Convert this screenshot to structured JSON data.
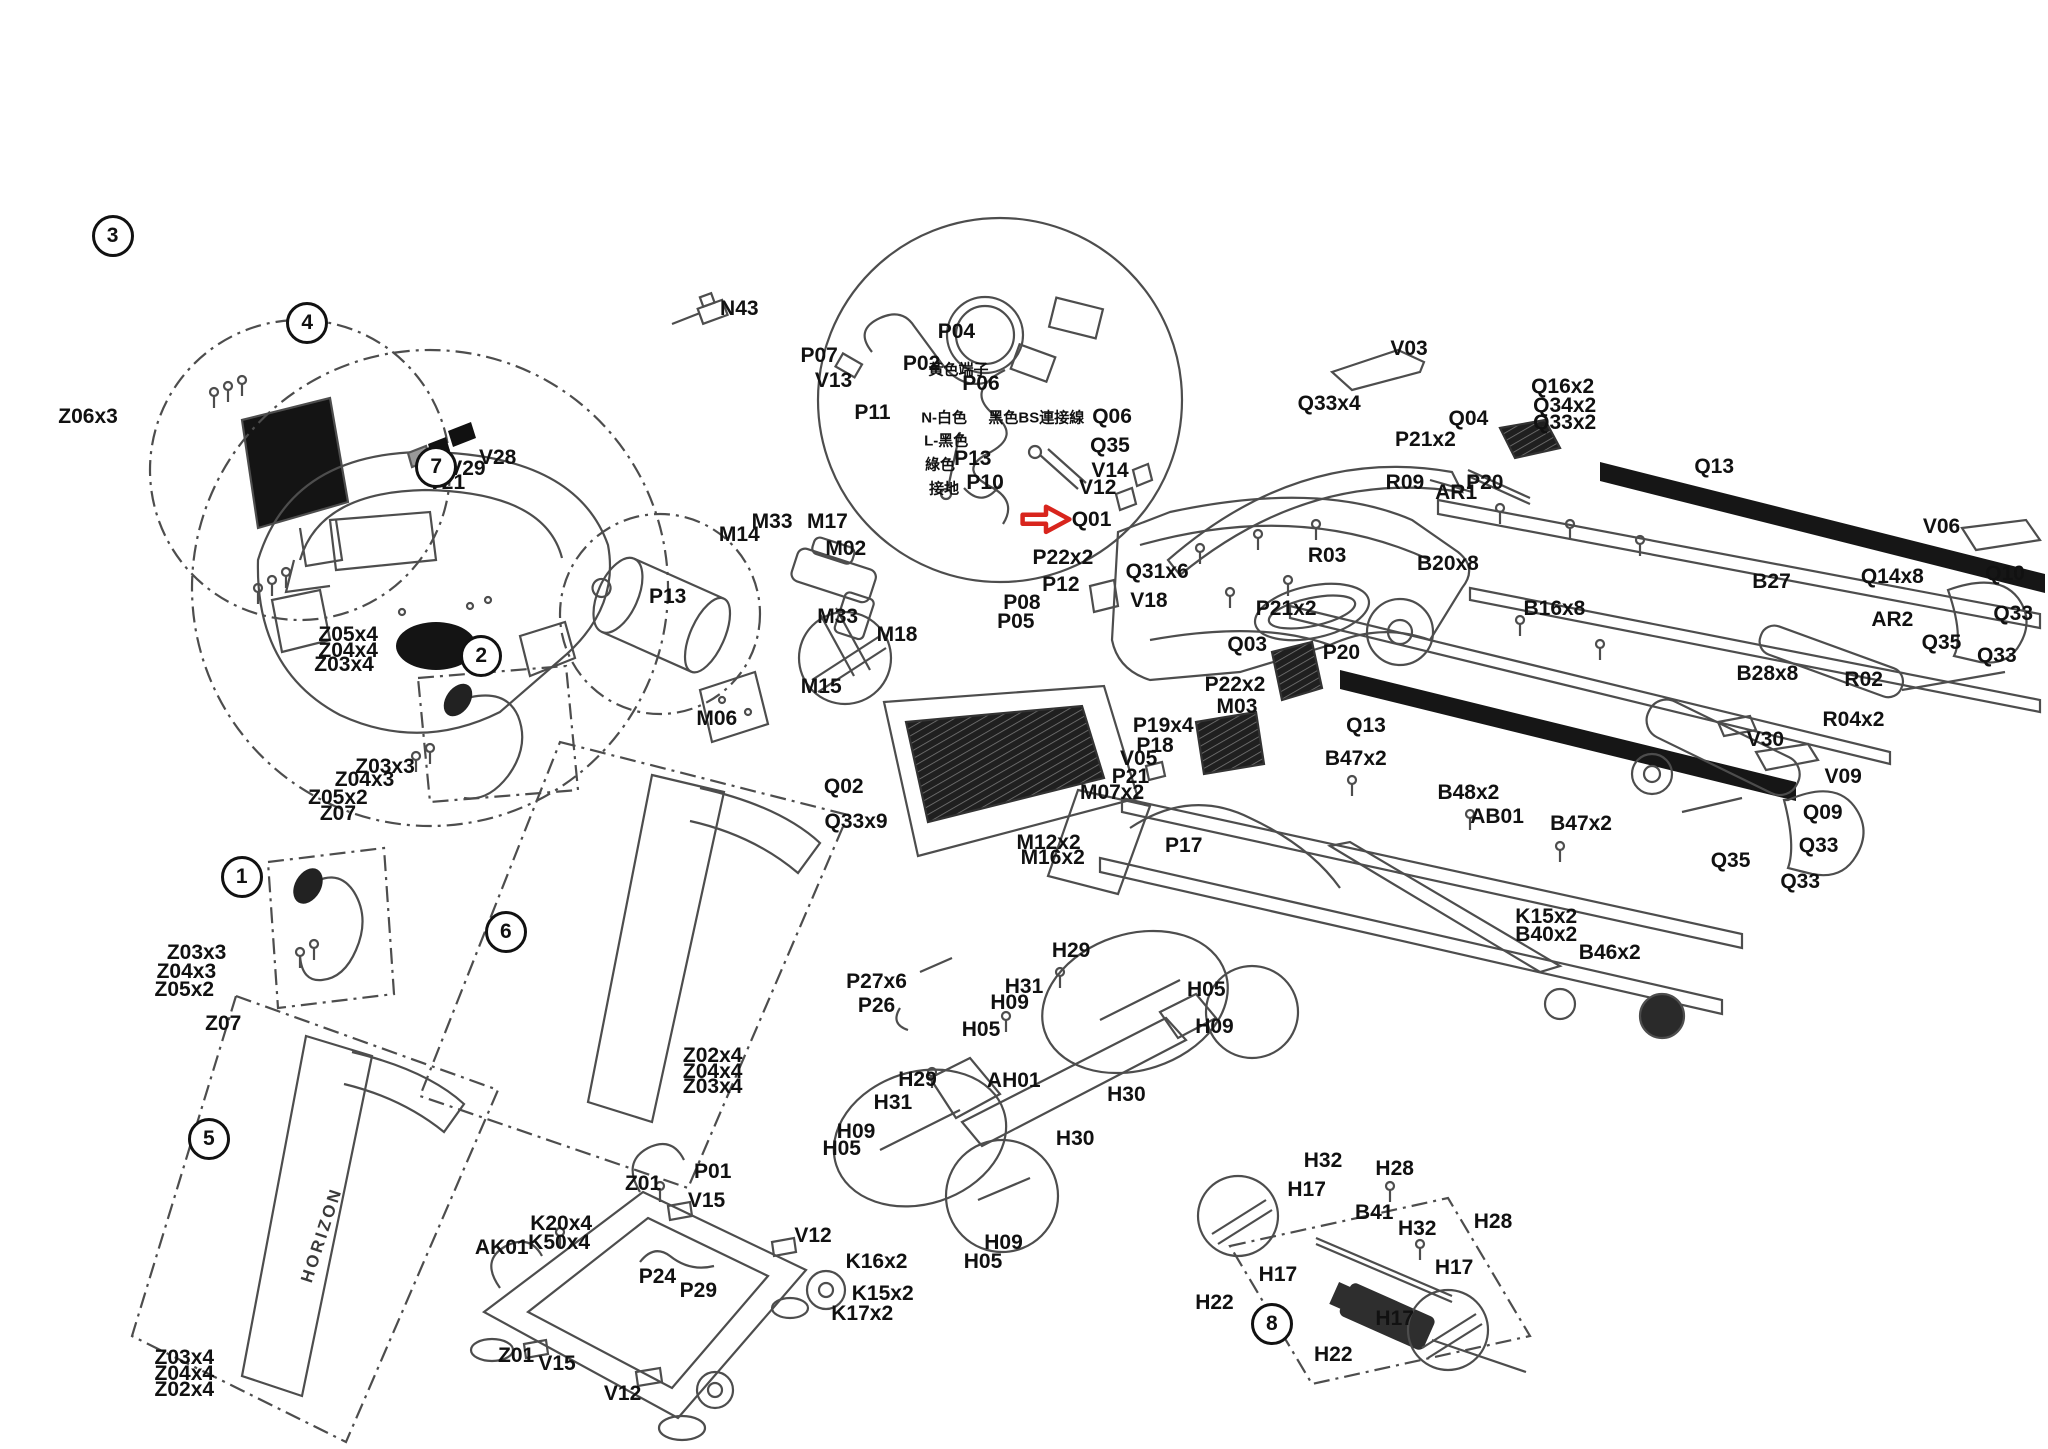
{
  "meta": {
    "diagram_type": "treadmill-exploded-parts-diagram"
  },
  "colors": {
    "label": "#111111",
    "line": "#4d4d4d",
    "dark_fill": "#161616",
    "highlight_arrow": "#d8251d",
    "sticker_gray": "#999999"
  },
  "brand": "HORIZON",
  "highlight": {
    "part_id": "Q01",
    "x": 52.4,
    "y": 35.9
  },
  "balloons": [
    {
      "n": "3",
      "x": 5.5,
      "y": 16.3
    },
    {
      "n": "4",
      "x": 15.0,
      "y": 22.3
    },
    {
      "n": "7",
      "x": 21.3,
      "y": 32.2
    },
    {
      "n": "2",
      "x": 23.5,
      "y": 45.3
    },
    {
      "n": "1",
      "x": 11.8,
      "y": 60.5
    },
    {
      "n": "6",
      "x": 24.7,
      "y": 64.3
    },
    {
      "n": "5",
      "x": 10.2,
      "y": 78.6
    },
    {
      "n": "8",
      "x": 62.1,
      "y": 91.4
    }
  ],
  "labels": [
    {
      "t": "Z06x3",
      "x": 4.3,
      "y": 28.8
    },
    {
      "t": "V28",
      "x": 24.3,
      "y": 31.6
    },
    {
      "t": "V29",
      "x": 22.8,
      "y": 32.4
    },
    {
      "t": "V21",
      "x": 21.8,
      "y": 33.3
    },
    {
      "t": "N43",
      "x": 36.1,
      "y": 21.3
    },
    {
      "t": "P07",
      "x": 40.0,
      "y": 24.6
    },
    {
      "t": "V13",
      "x": 40.7,
      "y": 26.3
    },
    {
      "t": "P11",
      "x": 42.6,
      "y": 28.5
    },
    {
      "t": "P02",
      "x": 45.0,
      "y": 25.1
    },
    {
      "t": "P04",
      "x": 46.7,
      "y": 22.9
    },
    {
      "t": "黃色端子",
      "x": 46.8,
      "y": 25.5,
      "cn": true
    },
    {
      "t": "P06",
      "x": 47.9,
      "y": 26.5
    },
    {
      "t": "N-白色",
      "x": 46.1,
      "y": 28.8,
      "cn": true
    },
    {
      "t": "黑色BS連接線",
      "x": 50.6,
      "y": 28.8,
      "cn": true
    },
    {
      "t": "L-黑色",
      "x": 46.2,
      "y": 30.4,
      "cn": true
    },
    {
      "t": "綠色",
      "x": 45.9,
      "y": 32.0,
      "cn": true
    },
    {
      "t": "P13",
      "x": 47.5,
      "y": 31.7
    },
    {
      "t": "接地",
      "x": 46.1,
      "y": 33.7,
      "cn": true
    },
    {
      "t": "P10",
      "x": 48.1,
      "y": 33.3
    },
    {
      "t": "V03",
      "x": 68.8,
      "y": 24.1
    },
    {
      "t": "Q06",
      "x": 54.3,
      "y": 28.8
    },
    {
      "t": "Q33x4",
      "x": 64.9,
      "y": 27.9
    },
    {
      "t": "Q35",
      "x": 54.2,
      "y": 30.8
    },
    {
      "t": "V14",
      "x": 54.2,
      "y": 32.5
    },
    {
      "t": "V12",
      "x": 53.6,
      "y": 33.7
    },
    {
      "t": "Q01",
      "x": 53.3,
      "y": 35.9
    },
    {
      "t": "Q31x6",
      "x": 56.5,
      "y": 39.5
    },
    {
      "t": "R03",
      "x": 64.8,
      "y": 38.4
    },
    {
      "t": "B20x8",
      "x": 70.7,
      "y": 38.9
    },
    {
      "t": "P21x2",
      "x": 62.8,
      "y": 42.0
    },
    {
      "t": "P20",
      "x": 65.5,
      "y": 45.1
    },
    {
      "t": "Q03",
      "x": 60.9,
      "y": 44.5
    },
    {
      "t": "V18",
      "x": 56.1,
      "y": 41.5
    },
    {
      "t": "P22x2",
      "x": 51.9,
      "y": 38.5
    },
    {
      "t": "P12",
      "x": 51.8,
      "y": 40.4
    },
    {
      "t": "P08",
      "x": 49.9,
      "y": 41.6
    },
    {
      "t": "P05",
      "x": 49.6,
      "y": 42.9
    },
    {
      "t": "Q16x2",
      "x": 76.3,
      "y": 26.7
    },
    {
      "t": "Q34x2",
      "x": 76.4,
      "y": 28.0
    },
    {
      "t": "Q33x2",
      "x": 76.4,
      "y": 29.2
    },
    {
      "t": "Q04",
      "x": 71.7,
      "y": 28.9
    },
    {
      "t": "P21x2",
      "x": 69.6,
      "y": 30.4
    },
    {
      "t": "P20",
      "x": 72.5,
      "y": 33.3
    },
    {
      "t": "AR1",
      "x": 71.1,
      "y": 34.0
    },
    {
      "t": "R09",
      "x": 68.6,
      "y": 33.3
    },
    {
      "t": "Q13",
      "x": 83.7,
      "y": 32.2
    },
    {
      "t": "V06",
      "x": 94.8,
      "y": 36.4
    },
    {
      "t": "Q10",
      "x": 97.9,
      "y": 39.6
    },
    {
      "t": "Q14x8",
      "x": 92.4,
      "y": 39.8
    },
    {
      "t": "B27",
      "x": 86.5,
      "y": 40.2
    },
    {
      "t": "Q33",
      "x": 98.3,
      "y": 42.4
    },
    {
      "t": "AR2",
      "x": 92.4,
      "y": 42.8
    },
    {
      "t": "Q35",
      "x": 94.8,
      "y": 44.4
    },
    {
      "t": "Q33",
      "x": 97.5,
      "y": 45.3
    },
    {
      "t": "B28x8",
      "x": 86.3,
      "y": 46.5
    },
    {
      "t": "R02",
      "x": 91.0,
      "y": 46.9
    },
    {
      "t": "R04x2",
      "x": 90.5,
      "y": 49.7
    },
    {
      "t": "V30",
      "x": 86.2,
      "y": 51.1
    },
    {
      "t": "B16x8",
      "x": 75.9,
      "y": 42.0
    },
    {
      "t": "M33",
      "x": 37.7,
      "y": 36.0
    },
    {
      "t": "M17",
      "x": 40.4,
      "y": 36.0
    },
    {
      "t": "M14",
      "x": 36.1,
      "y": 36.9
    },
    {
      "t": "M02",
      "x": 41.3,
      "y": 37.9
    },
    {
      "t": "P13",
      "x": 32.6,
      "y": 41.2
    },
    {
      "t": "M33",
      "x": 40.9,
      "y": 42.6
    },
    {
      "t": "M18",
      "x": 43.8,
      "y": 43.8
    },
    {
      "t": "M15",
      "x": 40.1,
      "y": 47.4
    },
    {
      "t": "M06",
      "x": 35.0,
      "y": 49.6
    },
    {
      "t": "Z05x4",
      "x": 17.0,
      "y": 43.8
    },
    {
      "t": "Z04x4",
      "x": 17.0,
      "y": 44.9
    },
    {
      "t": "Z03x4",
      "x": 16.8,
      "y": 45.9
    },
    {
      "t": "Z03x3",
      "x": 18.8,
      "y": 52.9
    },
    {
      "t": "Z04x3",
      "x": 17.8,
      "y": 53.8
    },
    {
      "t": "Z05x2",
      "x": 16.5,
      "y": 55.1
    },
    {
      "t": "Z07",
      "x": 16.5,
      "y": 56.2
    },
    {
      "t": "Z03x3",
      "x": 9.6,
      "y": 65.8
    },
    {
      "t": "Z04x3",
      "x": 9.1,
      "y": 67.1
    },
    {
      "t": "Z05x2",
      "x": 9.0,
      "y": 68.3
    },
    {
      "t": "Z07",
      "x": 10.9,
      "y": 70.7
    },
    {
      "t": "Q02",
      "x": 41.2,
      "y": 54.3
    },
    {
      "t": "Q33x9",
      "x": 41.8,
      "y": 56.7
    },
    {
      "t": "P19x4",
      "x": 56.8,
      "y": 50.1
    },
    {
      "t": "P18",
      "x": 56.4,
      "y": 51.5
    },
    {
      "t": "M03",
      "x": 60.4,
      "y": 48.8
    },
    {
      "t": "P22x2",
      "x": 60.3,
      "y": 47.3
    },
    {
      "t": "V05",
      "x": 55.6,
      "y": 52.4
    },
    {
      "t": "P21",
      "x": 55.2,
      "y": 53.6
    },
    {
      "t": "M07x2",
      "x": 54.3,
      "y": 54.7
    },
    {
      "t": "M12x2",
      "x": 51.2,
      "y": 58.2
    },
    {
      "t": "M16x2",
      "x": 51.4,
      "y": 59.2
    },
    {
      "t": "P17",
      "x": 57.8,
      "y": 58.4
    },
    {
      "t": "B47x2",
      "x": 66.2,
      "y": 52.4
    },
    {
      "t": "B48x2",
      "x": 71.7,
      "y": 54.7
    },
    {
      "t": "AB01",
      "x": 73.1,
      "y": 56.4
    },
    {
      "t": "B47x2",
      "x": 77.2,
      "y": 56.9
    },
    {
      "t": "Q13",
      "x": 66.7,
      "y": 50.1
    },
    {
      "t": "V09",
      "x": 90.0,
      "y": 53.6
    },
    {
      "t": "Q09",
      "x": 89.0,
      "y": 56.1
    },
    {
      "t": "Q33",
      "x": 88.8,
      "y": 58.4
    },
    {
      "t": "Q35",
      "x": 84.5,
      "y": 59.4
    },
    {
      "t": "Q33",
      "x": 87.9,
      "y": 60.9
    },
    {
      "t": "K15x2",
      "x": 75.5,
      "y": 63.3
    },
    {
      "t": "B40x2",
      "x": 75.5,
      "y": 64.5
    },
    {
      "t": "B46x2",
      "x": 78.6,
      "y": 65.8
    },
    {
      "t": "P27x6",
      "x": 42.8,
      "y": 67.8
    },
    {
      "t": "P26",
      "x": 42.8,
      "y": 69.4
    },
    {
      "t": "H29",
      "x": 52.3,
      "y": 65.6
    },
    {
      "t": "H31",
      "x": 50.0,
      "y": 68.1
    },
    {
      "t": "H09",
      "x": 49.3,
      "y": 69.2
    },
    {
      "t": "H05",
      "x": 47.9,
      "y": 71.1
    },
    {
      "t": "H05",
      "x": 58.9,
      "y": 68.3
    },
    {
      "t": "H09",
      "x": 59.3,
      "y": 70.9
    },
    {
      "t": "AH01",
      "x": 49.5,
      "y": 74.6
    },
    {
      "t": "H30",
      "x": 55.0,
      "y": 75.6
    },
    {
      "t": "H29",
      "x": 44.8,
      "y": 74.5
    },
    {
      "t": "H31",
      "x": 43.6,
      "y": 76.1
    },
    {
      "t": "H09",
      "x": 41.8,
      "y": 78.1
    },
    {
      "t": "H05",
      "x": 41.1,
      "y": 79.3
    },
    {
      "t": "H30",
      "x": 52.5,
      "y": 78.6
    },
    {
      "t": "H09",
      "x": 49.0,
      "y": 85.8
    },
    {
      "t": "H05",
      "x": 48.0,
      "y": 87.1
    },
    {
      "t": "Z02x4",
      "x": 34.8,
      "y": 72.9
    },
    {
      "t": "Z04x4",
      "x": 34.8,
      "y": 74.0
    },
    {
      "t": "Z03x4",
      "x": 34.8,
      "y": 75.0
    },
    {
      "t": "Z01",
      "x": 31.4,
      "y": 81.7
    },
    {
      "t": "P01",
      "x": 34.8,
      "y": 80.9
    },
    {
      "t": "V15",
      "x": 34.5,
      "y": 82.9
    },
    {
      "t": "K20x4",
      "x": 27.4,
      "y": 84.5
    },
    {
      "t": "K50x4",
      "x": 27.3,
      "y": 85.8
    },
    {
      "t": "AK01",
      "x": 24.5,
      "y": 86.1
    },
    {
      "t": "V12",
      "x": 39.7,
      "y": 85.3
    },
    {
      "t": "P24",
      "x": 32.1,
      "y": 88.1
    },
    {
      "t": "P29",
      "x": 34.1,
      "y": 89.1
    },
    {
      "t": "K16x2",
      "x": 42.8,
      "y": 87.1
    },
    {
      "t": "K15x2",
      "x": 43.1,
      "y": 89.3
    },
    {
      "t": "K17x2",
      "x": 42.1,
      "y": 90.7
    },
    {
      "t": "Z01",
      "x": 25.2,
      "y": 93.6
    },
    {
      "t": "V15",
      "x": 27.2,
      "y": 94.1
    },
    {
      "t": "V12",
      "x": 30.4,
      "y": 96.2
    },
    {
      "t": "Z03x4",
      "x": 9.0,
      "y": 93.7
    },
    {
      "t": "Z04x4",
      "x": 9.0,
      "y": 94.8
    },
    {
      "t": "Z02x4",
      "x": 9.0,
      "y": 95.9
    },
    {
      "t": "H32",
      "x": 64.6,
      "y": 80.1
    },
    {
      "t": "H28",
      "x": 68.1,
      "y": 80.7
    },
    {
      "t": "H17",
      "x": 63.8,
      "y": 82.1
    },
    {
      "t": "B41",
      "x": 67.1,
      "y": 83.7
    },
    {
      "t": "H32",
      "x": 69.2,
      "y": 84.8
    },
    {
      "t": "H28",
      "x": 72.9,
      "y": 84.3
    },
    {
      "t": "H17",
      "x": 71.0,
      "y": 87.5
    },
    {
      "t": "H17",
      "x": 62.4,
      "y": 88.0
    },
    {
      "t": "H22",
      "x": 59.3,
      "y": 89.9
    },
    {
      "t": "H17",
      "x": 68.1,
      "y": 91.0
    },
    {
      "t": "H22",
      "x": 65.1,
      "y": 93.5
    }
  ]
}
